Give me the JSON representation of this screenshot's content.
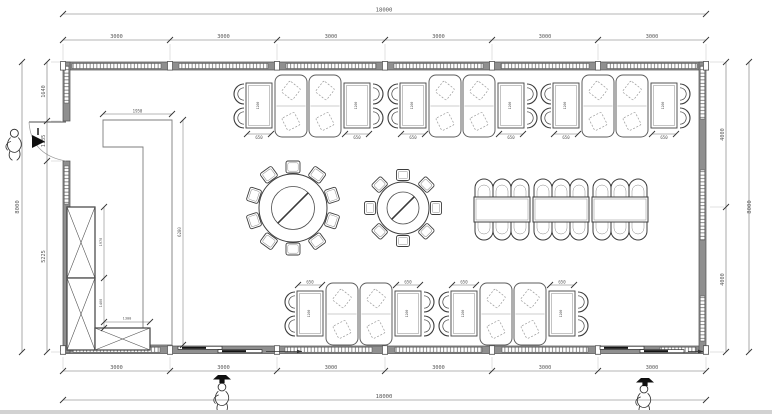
{
  "dimensions": {
    "overall_width": "18000",
    "overall_height": "8000",
    "top_segments": [
      "3000",
      "3000",
      "3000",
      "3000",
      "3000",
      "3000"
    ],
    "bottom_segments": [
      "3000",
      "3000",
      "3000",
      "3000",
      "3000",
      "3000"
    ],
    "left_segments": [
      "1640",
      "1135",
      "5225"
    ],
    "right_segments": [
      "4000",
      "4000"
    ],
    "booth_table_width": "650",
    "booth_table_length": "1200",
    "partition_width": "1950",
    "partition_height": "6280",
    "cabinet_upper_height": "1970",
    "cabinet_lower_height": "1400",
    "cabinet_depth": "1300"
  },
  "furniture": {
    "top_booth_groups": 3,
    "bottom_booth_groups": 2,
    "booths_per_group": 2,
    "side_tables_per_group": 2,
    "side_chairs_per_group": 4,
    "round_table_large_seats": 10,
    "round_table_small_seats": 8,
    "banquet_tables": 3,
    "banquet_seats": 18
  },
  "annotations": {
    "people_figures": 3,
    "swing_doors": 1,
    "sliding_doors": 2
  },
  "colors": {
    "line": "#4b4b4b",
    "soft": "#8a8a8a",
    "dim": "#6f6f6f",
    "ext": "#b5b5b5",
    "wall": "#8f8f8f",
    "wall_edge": "#4f4f4f",
    "glazing": "#5a5a5a",
    "paper": "#ffffff",
    "marker": "#0f0f0f",
    "edge_strip": "#d2d2d2"
  }
}
